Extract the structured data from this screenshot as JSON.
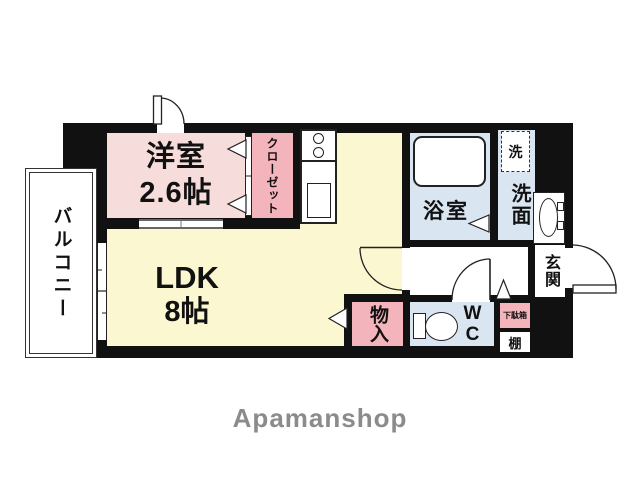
{
  "floorplan": {
    "brand": "Apamanshop",
    "wall_color": "#111111",
    "rooms": {
      "bedroom": {
        "name": "洋室",
        "size": "2.6帖",
        "color": "#f7dcdc"
      },
      "closet": {
        "name": "クローゼット",
        "color": "#f4b4bc"
      },
      "ldk": {
        "name": "LDK",
        "size": "8帖",
        "color": "#fbf7d0"
      },
      "balcony": {
        "name": "バルコニー",
        "color": "#ffffff"
      },
      "bathroom": {
        "name": "浴室",
        "color": "#d9e5f1"
      },
      "laundry": {
        "name": "洗"
      },
      "washroom": {
        "name": "洗面",
        "color": "#d9e5f1"
      },
      "entrance": {
        "name": "玄関"
      },
      "storage": {
        "name": "物入",
        "color": "#f4b4bc"
      },
      "wc": {
        "name": "WC",
        "color": "#d9e5f1"
      },
      "shoe_cabinet": {
        "name": "下駄箱",
        "color": "#f4b4bc"
      },
      "shelf": {
        "name": "棚"
      }
    }
  }
}
